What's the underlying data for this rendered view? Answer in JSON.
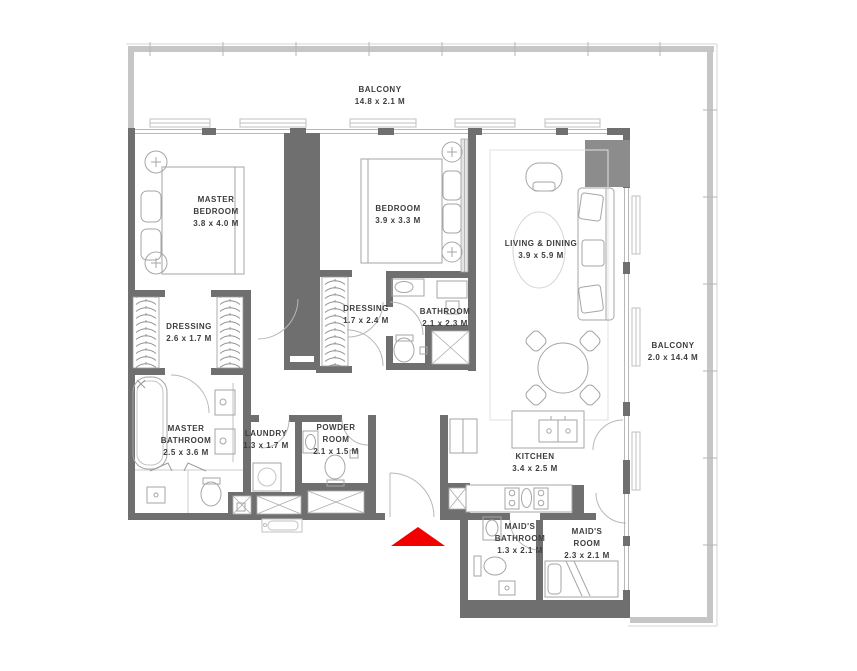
{
  "plan": {
    "type": "apartment-floor-plan",
    "colors": {
      "wall": "#6f6f6f",
      "railing": "#c6c6c6",
      "fixture_stroke": "#a6a6a6",
      "entrance_arrow": "#f20000",
      "label_text": "#3d3d3d"
    },
    "rooms": [
      {
        "id": "balcony-top",
        "name": "BALCONY",
        "dims": "14.8 x 2.1 M"
      },
      {
        "id": "master-bedroom",
        "name": "MASTER BEDROOM",
        "dims": "3.8 x 4.0 M"
      },
      {
        "id": "bedroom",
        "name": "BEDROOM",
        "dims": "3.9 x 3.3 M"
      },
      {
        "id": "living-dining",
        "name": "LIVING & DINING",
        "dims": "3.9 x 5.9 M"
      },
      {
        "id": "dressing-1",
        "name": "DRESSING",
        "dims": "2.6 x 1.7 M"
      },
      {
        "id": "dressing-2",
        "name": "DRESSING",
        "dims": "1.7 x 2.4 M"
      },
      {
        "id": "bathroom",
        "name": "BATHROOM",
        "dims": "2.1 x 2.3 M"
      },
      {
        "id": "master-bathroom",
        "name": "MASTER BATHROOM",
        "dims": "2.5 x 3.6 M"
      },
      {
        "id": "laundry",
        "name": "LAUNDRY",
        "dims": "1.3 x 1.7 M"
      },
      {
        "id": "powder-room",
        "name": "POWDER ROOM",
        "dims": "2.1 x 1.5 M"
      },
      {
        "id": "kitchen",
        "name": "KITCHEN",
        "dims": "3.4 x 2.5 M"
      },
      {
        "id": "maids-bathroom",
        "name": "MAID'S BATHROOM",
        "dims": "1.3 x 2.1 M"
      },
      {
        "id": "maids-room",
        "name": "MAID'S ROOM",
        "dims": "2.3 x 2.1 M"
      },
      {
        "id": "balcony-right",
        "name": "BALCONY",
        "dims": "2.0 x 14.4 M"
      }
    ]
  }
}
